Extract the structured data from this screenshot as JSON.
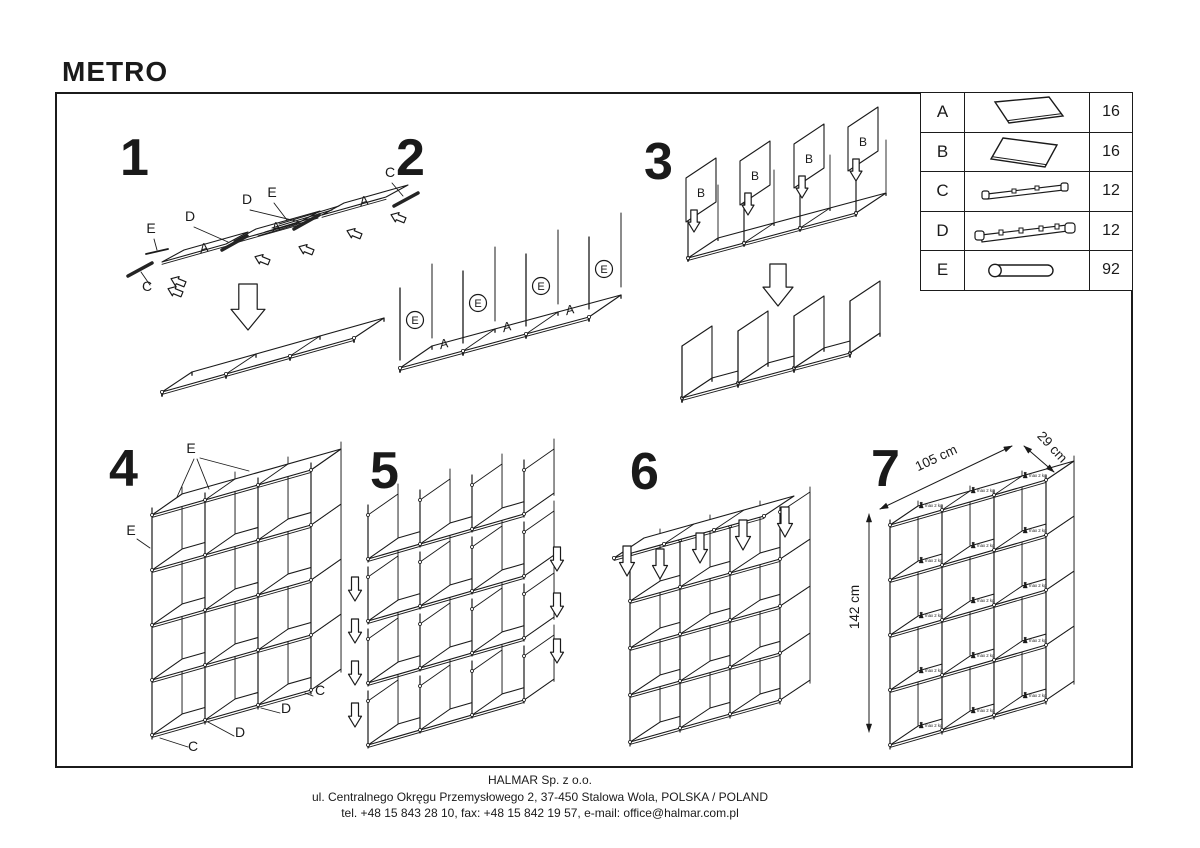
{
  "title": "METRO",
  "parts_table": {
    "rows": [
      {
        "letter": "A",
        "icon": "shelf-panel-icon",
        "qty": "16"
      },
      {
        "letter": "B",
        "icon": "divider-panel-icon",
        "qty": "16"
      },
      {
        "letter": "C",
        "icon": "end-rail-icon",
        "qty": "12"
      },
      {
        "letter": "D",
        "icon": "connector-rail-icon",
        "qty": "12"
      },
      {
        "letter": "E",
        "icon": "tube-icon",
        "qty": "92"
      }
    ]
  },
  "steps": {
    "s1": {
      "number": "1",
      "panel_label": "A",
      "label_c": "C",
      "label_d": "D",
      "label_e": "E"
    },
    "s2": {
      "number": "2",
      "panel_label": "A",
      "connector_label": "E"
    },
    "s3": {
      "number": "3",
      "panel_label": "B"
    },
    "s4": {
      "number": "4",
      "label_c": "C",
      "label_d": "D",
      "label_e": "E"
    },
    "s5": {
      "number": "5"
    },
    "s6": {
      "number": "6"
    },
    "s7": {
      "number": "7",
      "dim_width": "105 cm",
      "dim_depth": "29 cm",
      "dim_height": "142 cm",
      "max_load": "max 2 kg"
    }
  },
  "footer": {
    "company": "HALMAR Sp. z o.o.",
    "address": "ul. Centralnego Okręgu Przemysłowego 2, 37-450 Stalowa Wola, POLSKA / POLAND",
    "contact": "tel. +48 15 843 28 10, fax: +48 15 842 19 57, e-mail: office@halmar.com.pl"
  }
}
